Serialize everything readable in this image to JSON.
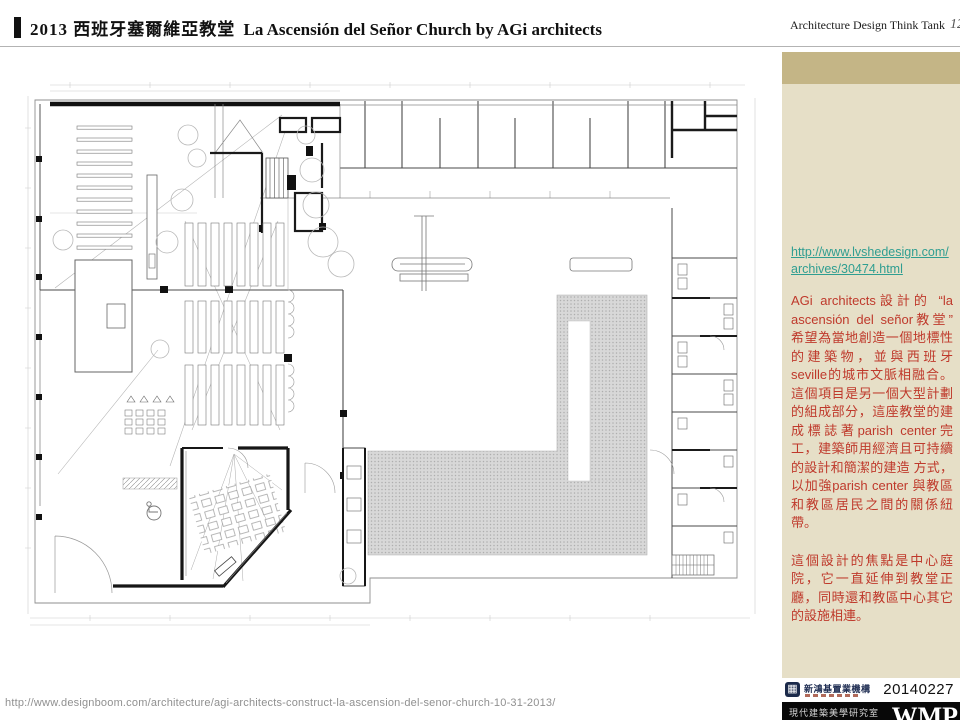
{
  "header": {
    "title_zh": "2013 西班牙塞爾維亞教堂",
    "title_en": "La Ascensión del Señor Church by AGi architects",
    "brand": "Architecture Design Think Tank",
    "page_number": "12"
  },
  "sidebar": {
    "link": "http://www.lvshedesign.com/archives/30474.html",
    "paragraph1": "AGi architects設計的 “la ascensión del señor教堂” 希望為當地創造一個地標性的建築物，並與西班牙seville的城市文脈相融合。 這個項目是另一個大型計劃的組成部分，這座教堂的建成標誌著parish center完工，建築師用經濟且可持續的設計和簡潔的建造 方式，以加強parish center 與教區和教區居民之間的關係紐帶。",
    "paragraph2": "這個設計的焦點是中心庭院，它一直延伸到教堂正廳，同時還和教區中心其它的設施相連。"
  },
  "footer": {
    "source_url": "http://www.designboom.com/architecture/agi-architects-construct-la-ascension-del-senor-church-10-31-2013/",
    "date": "20140227",
    "logo_text": "新鴻基置業機構",
    "logo_glyph": "▦",
    "studio_label": "現代建築美學研究室",
    "watermark": "WMP"
  },
  "colors": {
    "accent_tan": "#c4b586",
    "sidebar_bg": "#e6dfc7",
    "link_teal": "#2f9e91",
    "text_red": "#bf392b"
  }
}
